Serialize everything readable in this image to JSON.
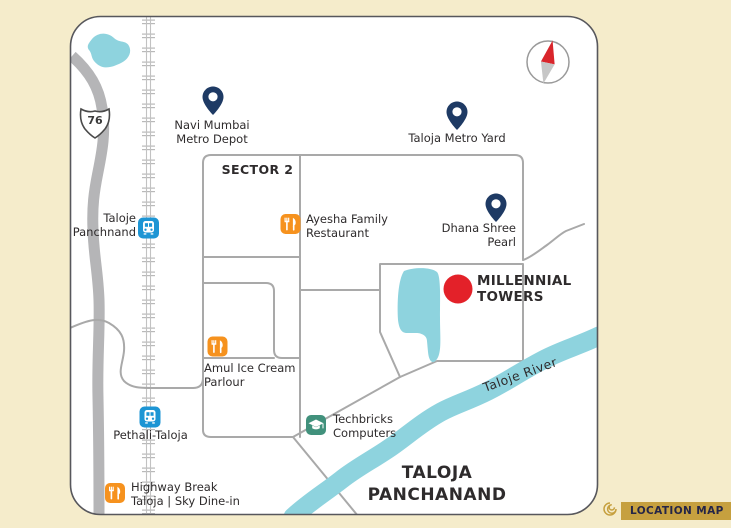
{
  "colors": {
    "page_bg": "#f5eccb",
    "card_border": "#57575c",
    "ink": "#2e2b2c",
    "road": "#a9a9a9",
    "highway": "#b5b5b7",
    "water": "#8ed3de",
    "pin": "#1e3a64",
    "station": "#1d95d4",
    "restaurant": "#f6921e",
    "education": "#41917c",
    "marker": "#e32129",
    "gold": "#c6a03f",
    "badge_text": "#252547",
    "compass_red": "#d9252b",
    "compass_gray": "#c6c6c6"
  },
  "map": {
    "highway_number": "76",
    "sector_label": "SECTOR 2",
    "area_label": "TALOJA\nPANCHANAND",
    "river_label": "Taloje River",
    "project": {
      "name": "MILLENNIAL\nTOWERS"
    },
    "pins": [
      {
        "label": "Navi Mumbai\nMetro Depot"
      },
      {
        "label": "Taloja Metro Yard"
      },
      {
        "label": "Dhana Shree\nPearl"
      }
    ],
    "railway_stations": [
      {
        "label": "Taloje\nPanchnand"
      },
      {
        "label": "Pethali-Taloja"
      }
    ],
    "restaurants": [
      {
        "label": "Ayesha Family\nRestaurant"
      },
      {
        "label": "Amul Ice Cream\nParlour"
      },
      {
        "label": "Highway Break\nTaloja | Sky Dine-in"
      }
    ],
    "institutes": [
      {
        "label": "Techbricks\nComputers"
      }
    ]
  },
  "badge": {
    "label": "LOCATION MAP"
  }
}
